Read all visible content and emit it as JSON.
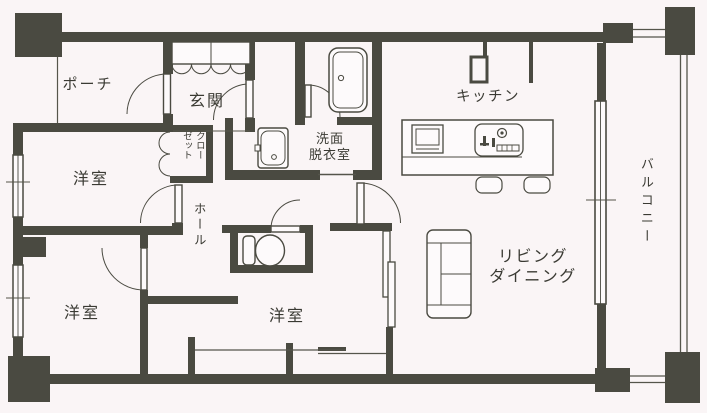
{
  "plan": {
    "type": "floor-plan",
    "colors": {
      "background": "#faf5f6",
      "wall": "#4a4a41",
      "thin_line": "#55554b",
      "text": "#3a3a33",
      "fixture_fill": "#fdfafb"
    },
    "rooms": {
      "porch": {
        "label": "ポーチ"
      },
      "entrance": {
        "label": "玄関"
      },
      "bedroom_upper": {
        "label": "洋室"
      },
      "closet": {
        "label": "クロー\nゼット",
        "full_name": "クローゼット"
      },
      "hall": {
        "label": "ホール"
      },
      "washroom": {
        "label": "洗面\n脱衣室",
        "full_name": "洗面脱衣室"
      },
      "kitchen": {
        "label": "キッチン"
      },
      "living_dining": {
        "label": "リビング\nダイニング",
        "full_name": "リビングダイニング"
      },
      "balcony": {
        "label": "バルコニー"
      },
      "bedroom_lower_left": {
        "label": "洋室"
      },
      "bedroom_lower_center": {
        "label": "洋室"
      }
    },
    "fixtures": [
      "bathtub",
      "washbasin",
      "toilet",
      "kitchen-counter",
      "kitchen-sink",
      "cooktop",
      "stool",
      "stool",
      "sofa",
      "shoe-cabinet"
    ]
  }
}
